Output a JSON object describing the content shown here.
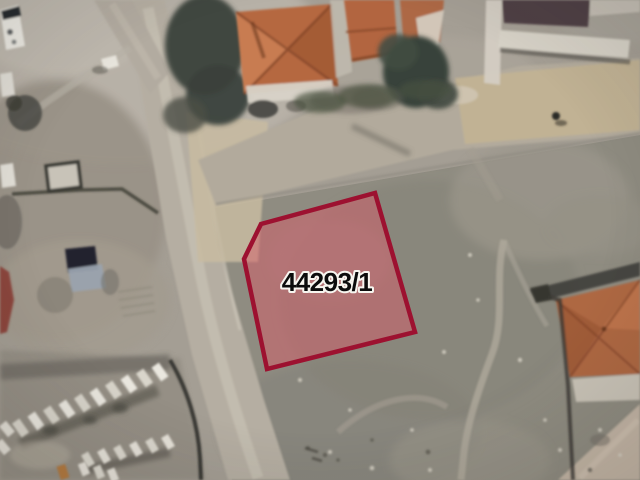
{
  "map": {
    "parcel": {
      "label": "44293/1",
      "points": "375,193 415,332 267,369 244,259 261,224",
      "fill_color": "rgba(214,92,104,0.5)",
      "stroke_color": "#9d1130",
      "stroke_width": "4.5",
      "label_fill": "#0c0c0c",
      "label_halo": "#f7f5ef"
    }
  }
}
